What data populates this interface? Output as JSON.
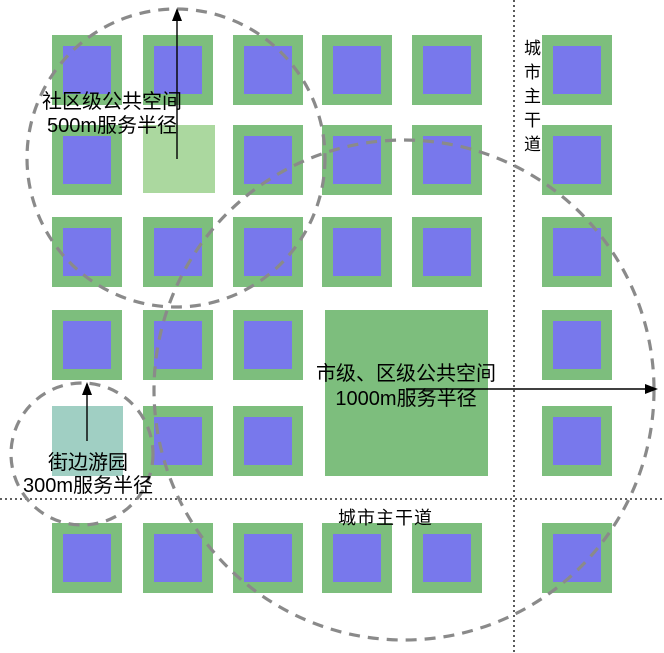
{
  "labels": {
    "community": {
      "line1": "社区级公共空间",
      "line2": "500m服务半径"
    },
    "street_garden": {
      "line1": "街边游园",
      "line2": "300m服务半径"
    },
    "city_district": {
      "line1": "市级、区级公共空间",
      "line2": "1000m服务半径"
    },
    "road_right": "城市主干道",
    "road_bottom": "城市主干道"
  },
  "colors": {
    "block_green": "#7dbe7d",
    "block_blue": "#7878ec",
    "community_green": "#abd89f",
    "street_garden_teal": "#a0cfc3",
    "city_district_green": "#7dbe7d",
    "dash_gray": "#8a8a8a",
    "road_line": "#000000",
    "arrow_line": "#000000",
    "text": "#000000",
    "background": "#ffffff"
  },
  "grid": {
    "col_x": [
      52,
      143,
      233,
      322,
      412,
      542
    ],
    "row_y": [
      35,
      125,
      217,
      310,
      406,
      523
    ],
    "block_size": 70,
    "inner_inset": 11,
    "cells": [
      [
        0,
        0
      ],
      [
        1,
        0
      ],
      [
        2,
        0
      ],
      [
        3,
        0
      ],
      [
        4,
        0
      ],
      [
        5,
        0
      ],
      [
        0,
        1
      ],
      [
        2,
        1
      ],
      [
        3,
        1
      ],
      [
        4,
        1
      ],
      [
        5,
        1
      ],
      [
        0,
        2
      ],
      [
        1,
        2
      ],
      [
        2,
        2
      ],
      [
        3,
        2
      ],
      [
        4,
        2
      ],
      [
        5,
        2
      ],
      [
        0,
        3
      ],
      [
        1,
        3
      ],
      [
        2,
        3
      ],
      [
        5,
        3
      ],
      [
        1,
        4
      ],
      [
        2,
        4
      ],
      [
        5,
        4
      ],
      [
        0,
        5
      ],
      [
        1,
        5
      ],
      [
        2,
        5
      ],
      [
        3,
        5
      ],
      [
        4,
        5
      ],
      [
        5,
        5
      ]
    ]
  },
  "spaces": [
    {
      "name": "community-public-space",
      "x": 143,
      "y": 125,
      "w": 72,
      "h": 68,
      "color_key": "community_green"
    },
    {
      "name": "street-side-garden",
      "x": 52,
      "y": 406,
      "w": 71,
      "h": 70,
      "color_key": "street_garden_teal"
    },
    {
      "name": "city-district-public-space",
      "x": 325,
      "y": 310,
      "w": 163,
      "h": 166,
      "color_key": "city_district_green"
    }
  ],
  "circles": [
    {
      "name": "community-500m-radius-circle",
      "cx": 176,
      "cy": 158,
      "r": 149
    },
    {
      "name": "street-garden-300m-radius-circle",
      "cx": 82,
      "cy": 454,
      "r": 71
    },
    {
      "name": "city-district-1000m-radius-circle",
      "cx": 404,
      "cy": 390,
      "r": 250
    }
  ],
  "arrows": [
    {
      "name": "community-radius-arrow",
      "x1": 177,
      "y1": 159,
      "x2": 177,
      "y2": 10,
      "dir": "up"
    },
    {
      "name": "street-garden-radius-arrow",
      "x1": 87,
      "y1": 441,
      "x2": 87,
      "y2": 384,
      "dir": "up"
    },
    {
      "name": "city-district-radius-arrow",
      "x1": 406,
      "y1": 389,
      "x2": 655,
      "y2": 389,
      "dir": "right"
    }
  ],
  "roads": {
    "vertical_x": 514,
    "horizontal_y": 499,
    "width": 664,
    "height": 653
  }
}
